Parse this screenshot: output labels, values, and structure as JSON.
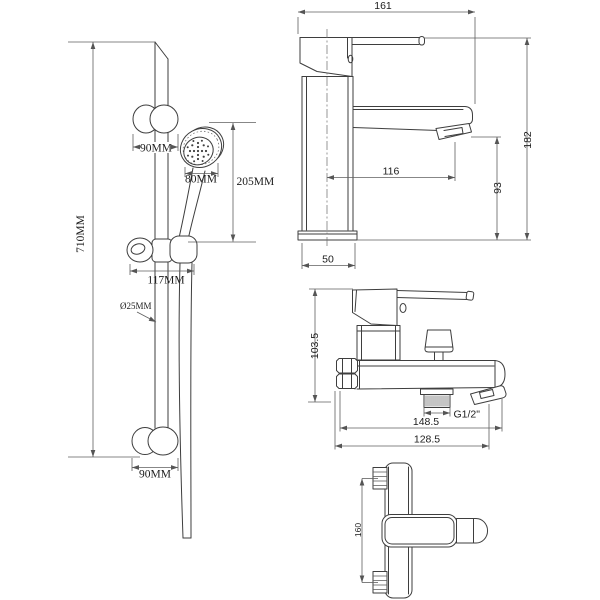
{
  "colors": {
    "background": "#ffffff",
    "object_line": "#3e3e3e",
    "dimension_line": "#5f5f5f",
    "label_text": "#1c1c1c"
  },
  "shower_rail": {
    "height": "710MM",
    "top_bracket_width": "90MM",
    "head_diameter": "80MM",
    "head_offset": "205MM",
    "holder_width": "117MM",
    "tube_diameter": "Ø25MM",
    "bottom_bracket_width": "90MM"
  },
  "basin_mixer": {
    "overall_width": "161",
    "overall_height": "182",
    "spout_reach": "116",
    "spout_height": "93",
    "base_depth": "50"
  },
  "bath_mixer": {
    "height": "103.5",
    "thread": "G1/2\"",
    "overall_length": "148.5",
    "body_length": "128.5"
  },
  "top_view": {
    "inlet_centers": "160"
  }
}
